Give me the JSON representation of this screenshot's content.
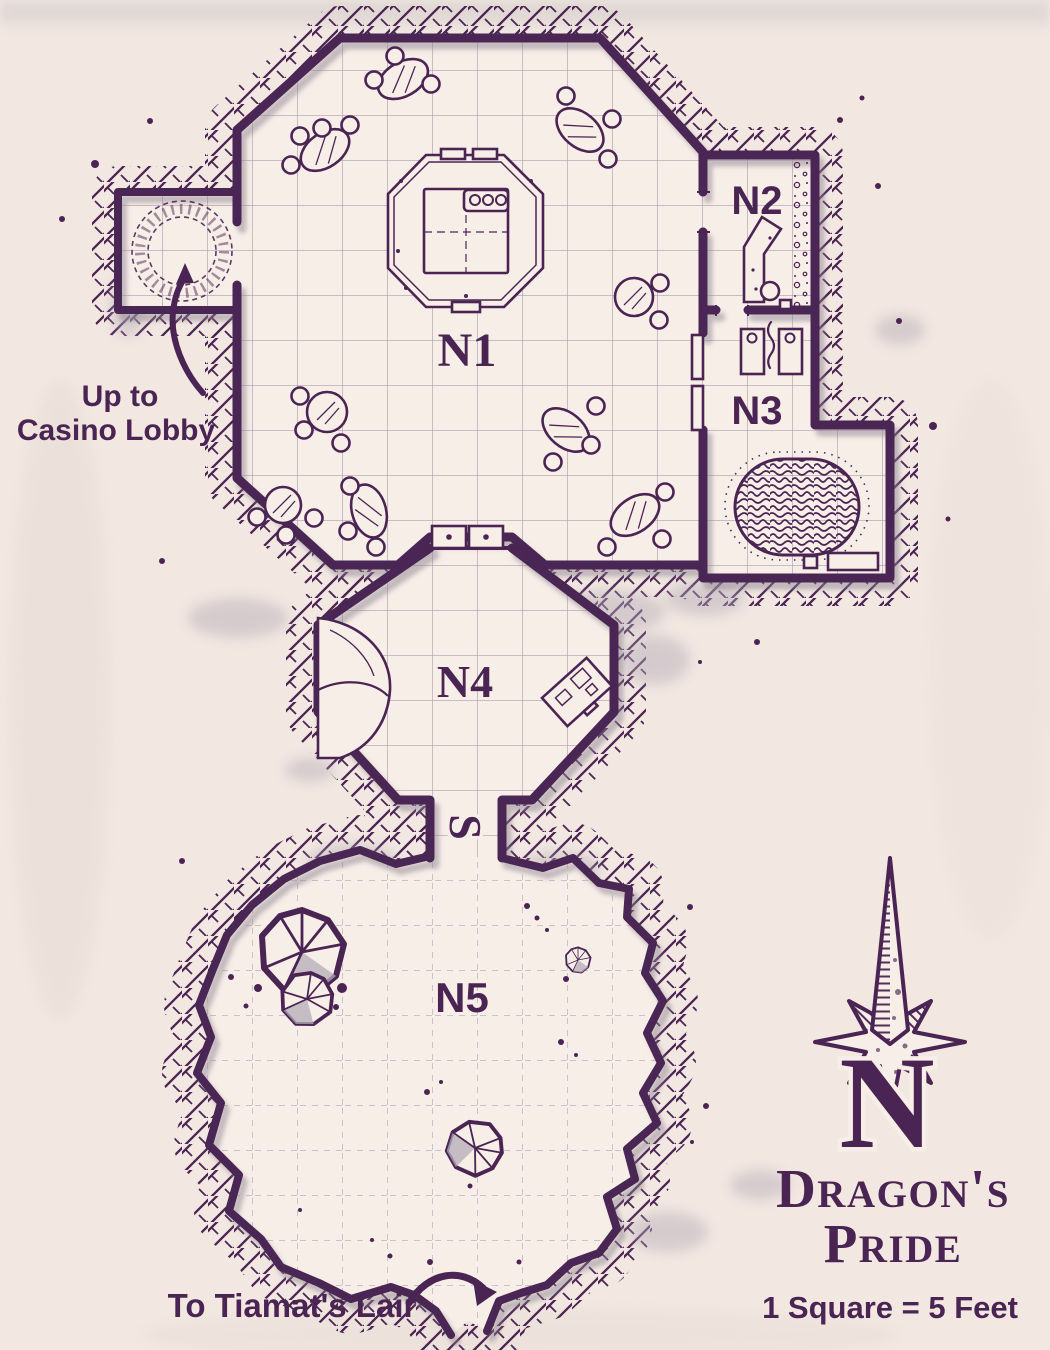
{
  "map": {
    "title": {
      "line1": "Dragon's",
      "line2": "Pride"
    },
    "scale_note": "1 Square = 5 Feet",
    "compass": {
      "letter": "N"
    },
    "rooms": [
      {
        "id": "n1",
        "label": "N1"
      },
      {
        "id": "n2",
        "label": "N2"
      },
      {
        "id": "n3",
        "label": "N3"
      },
      {
        "id": "n4",
        "label": "N4"
      },
      {
        "id": "n5",
        "label": "N5"
      }
    ],
    "annotations": {
      "portal_line1": "Up to",
      "portal_line2": "Casino Lobby",
      "exit_label": "To Tiamat's Lair",
      "secret_stair_marker": "S"
    },
    "features": [
      "teleport-circle",
      "octagonal-bar-counter",
      "double-door",
      "open-double-door",
      "counter",
      "rubble-strip",
      "slot-machines",
      "treasure-hoard",
      "boulder",
      "desk",
      "secret-stair-marker",
      "stalagmites",
      "cave-exit",
      "compass-rose"
    ],
    "colors": {
      "ink": "#4a2553",
      "paper": "#f2e7e1",
      "paper2": "#f8eee8",
      "grid": "#9c8aa4",
      "shade": "#b4abb8",
      "shadow": "#8d8291"
    }
  }
}
